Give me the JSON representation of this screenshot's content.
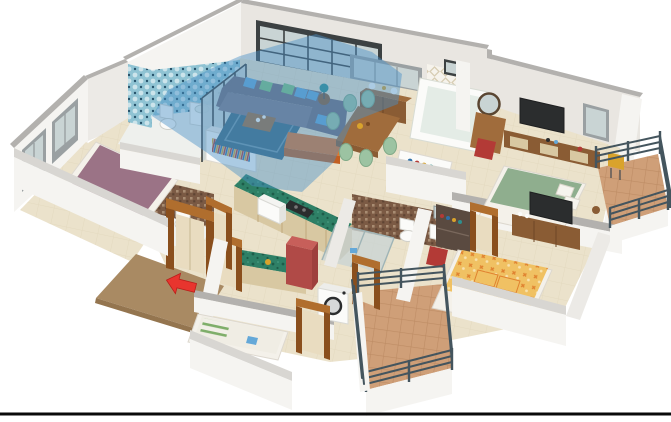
{
  "scene": {
    "description": "3D isometric cutaway floor plan render of a 3-bedroom apartment, white background",
    "width": 671,
    "height": 422,
    "bottom_rule": {
      "present": true,
      "color": "#0a0a0a"
    }
  },
  "rooms": [
    {
      "id": "living-room",
      "label": "Living room (highlighted selection)",
      "highlighted": true,
      "highlight_color": "#4a90c8"
    },
    {
      "id": "dining-area",
      "label": "Dining area with wood table and six green chairs",
      "highlighted": false
    },
    {
      "id": "kitchen",
      "label": "Kitchen with green L-counter, microwave, stove and red refrigerator",
      "highlighted": false
    },
    {
      "id": "bathroom-blue",
      "label": "Blue tiled bathroom with toilet and sink",
      "highlighted": false
    },
    {
      "id": "bedroom-left",
      "label": "Bedroom with mauve bed and corner windows",
      "highlighted": false
    },
    {
      "id": "ensuite-bathroom",
      "label": "Ensuite bathroom with brown mosaic tiles",
      "highlighted": false
    },
    {
      "id": "shower-bathroom",
      "label": "Bathroom with glass shower, toilet and sink",
      "highlighted": false
    },
    {
      "id": "bathtub-bathroom",
      "label": "Bathroom with bathtub and patterned tile wall",
      "highlighted": false
    },
    {
      "id": "bedroom-right",
      "label": "Bedroom with green bed, TV, dresser mirror and desk",
      "highlighted": false
    },
    {
      "id": "bedroom-bottom",
      "label": "Bedroom with yellow patterned bed, TV console and wardrobe",
      "highlighted": false
    },
    {
      "id": "utility-bedroom",
      "label": "Small bedroom with striped pillow bed and washing machine",
      "highlighted": false
    },
    {
      "id": "balcony-upper",
      "label": "Upper right balcony with terracotta tiles and dark railing",
      "highlighted": false
    },
    {
      "id": "balcony-lower",
      "label": "Lower balcony with terracotta tiles and dark railing",
      "highlighted": false
    },
    {
      "id": "entry",
      "label": "Entry landing with brown doormat and red direction arrow",
      "highlighted": false
    }
  ],
  "annotations": {
    "entry_arrow": {
      "shape": "arrow",
      "color": "#e8352e",
      "points_toward": "entry door"
    },
    "selection_overlay": {
      "room": "living-room",
      "color": "#4a90c8",
      "opacity": 0.45
    }
  },
  "colors": {
    "wall_face": "#f5f4f1",
    "wall_face_shadow": "#eceae6",
    "wall_inner": "#e9e6e1",
    "wall_top": "#b3b1ae",
    "wall_cut_top": "#d8d6d2",
    "floor": "#ebe2cb",
    "floor_grout": "#dcd1b4",
    "bath_floor": "#eef0ed",
    "highlight": "#4a90c8",
    "glass": "#c9d4d4",
    "frame_dark": "#3c4142",
    "frame_gray": "#9aa0a2",
    "tile_blue": "#8fc3d3",
    "tile_blue_dark": "#27536b",
    "mosaic_brown": "#7b5a44",
    "mosaic_light": "#a88c72",
    "pattern_beige": "#d8cdb4",
    "sofa": "#716c7a",
    "sofa_light": "#807b89",
    "pillow_blue": "#64a8d8",
    "pillow_green": "#7cc47f",
    "sofa_orange": "#e0762f",
    "sofa_orange_dark": "#c25f22",
    "rug": "#3f6a80",
    "wood": "#8a5c34",
    "wood_light": "#a06c3c",
    "wood_door": "#b06e2e",
    "wood_door_dark": "#8a4f1d",
    "door_panel": "#e9dcc0",
    "chair_green": "#9cc3a2",
    "counter_green": "#2e8066",
    "counter_green_dark": "#1d5c49",
    "cabinet_tan": "#d8c8a2",
    "fridge_red": "#b04a47",
    "fridge_red_light": "#c75f5a",
    "fridge_red_dark": "#9e3f3d",
    "railing": "#44555e",
    "terracotta": "#cf9f78",
    "terracotta_line": "#b9875f",
    "mat_brown": "#a98a63",
    "mat_brown_dark": "#94754f",
    "arrow_red": "#e8352e",
    "bed_mauve": "#9b7386",
    "bed_green": "#8fae8e",
    "bed_yellow": "#f0c163",
    "bed_yellow_accent": "#e0822f",
    "sheet_white": "#f4f1ea",
    "tv_dark": "#2b2d2e",
    "white_fixture": "#fbfbf9",
    "teal_lamp": "#2e8f8f",
    "chair_red": "#b33a36",
    "chair_yellow": "#d9a32c",
    "stripe_green": "#7fae6a",
    "wardrobe_dark": "#5a4a40",
    "black_rule": "#0a0a0a"
  }
}
